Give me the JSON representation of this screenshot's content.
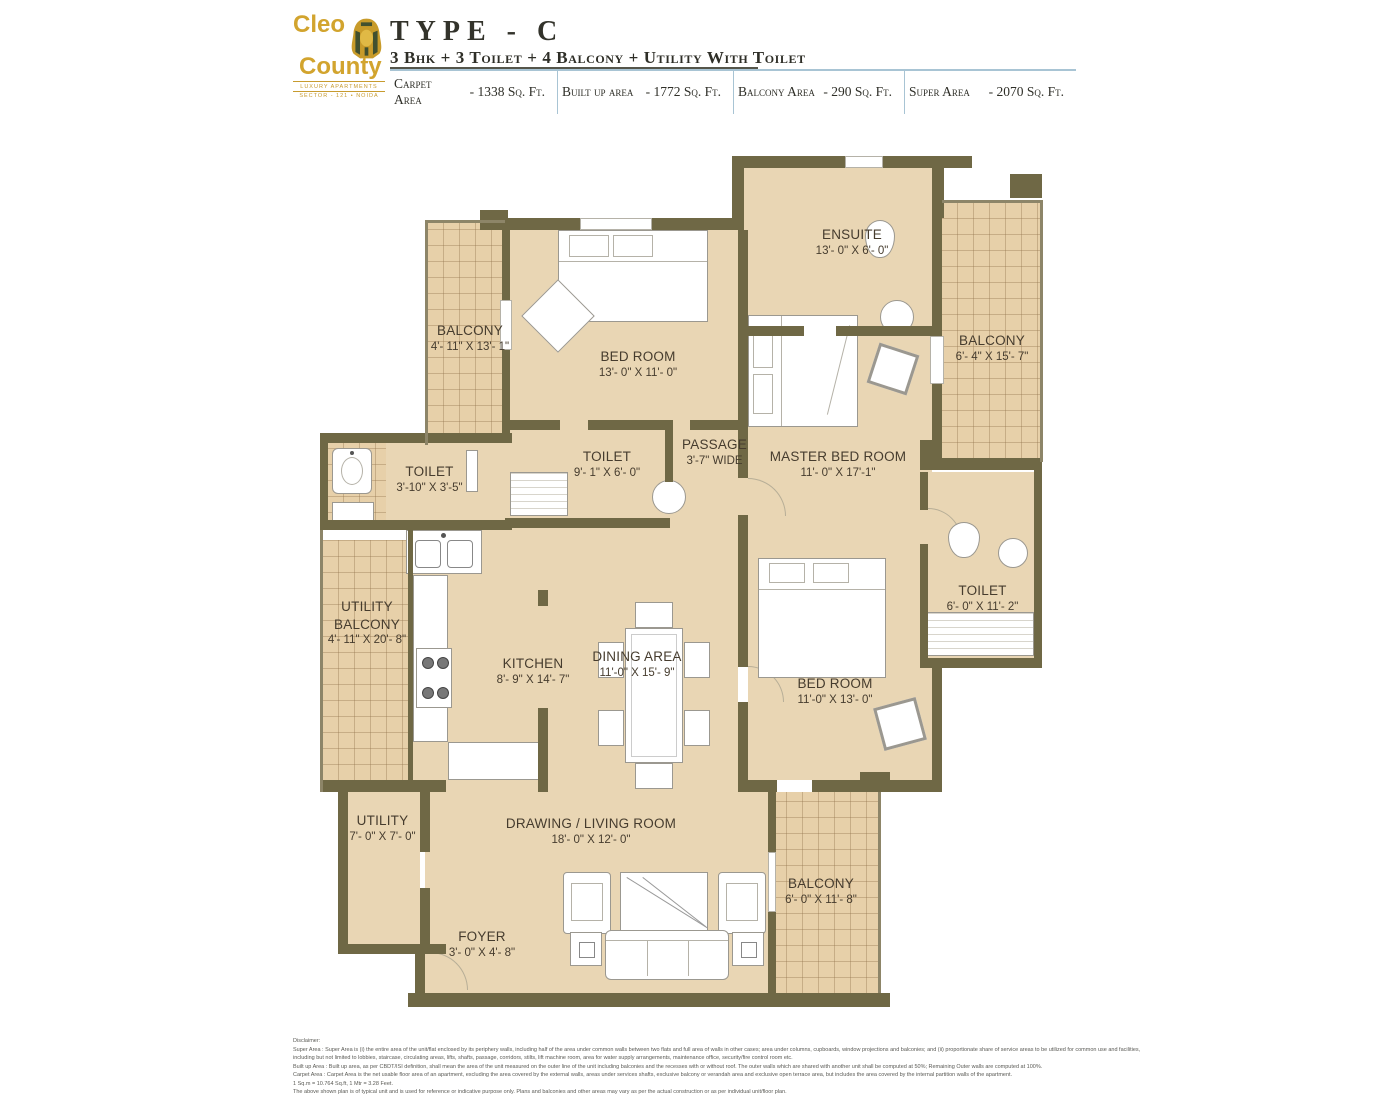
{
  "header": {
    "logo": {
      "line1": "Cleo",
      "line2": "County",
      "sub1": "LUXURY APARTMENTS",
      "sub2": "SECTOR - 121 • NOIDA"
    },
    "title": "TYPE - C",
    "subtitle": "3 Bhk + 3 Toilet + 4 Balcony + Utility With Toilet",
    "areas": [
      {
        "label": "Carpet Area",
        "value": "- 1338 Sq. Ft."
      },
      {
        "label": "Built up area",
        "value": "- 1772 Sq. Ft."
      },
      {
        "label": "Balcony Area",
        "value": "- 290 Sq. Ft."
      },
      {
        "label": "Super Area",
        "value": "- 2070 Sq. Ft."
      }
    ]
  },
  "rooms": [
    {
      "name": "BALCONY",
      "dim": "4'- 11\" X 13'- 1\""
    },
    {
      "name": "BED ROOM",
      "dim": "13'- 0\" X 11'- 0\""
    },
    {
      "name": "ENSUITE",
      "dim": "13'- 0\" X 6'- 0\""
    },
    {
      "name": "BALCONY",
      "dim": "6'- 4\" X 15'- 7\""
    },
    {
      "name": "MASTER BED ROOM",
      "dim": "11'- 0\" X 17'-1\""
    },
    {
      "name": "PASSAGE",
      "dim": "3'-7\" WIDE"
    },
    {
      "name": "TOILET",
      "dim": "9'- 1\" X 6'- 0\""
    },
    {
      "name": "TOILET",
      "dim": "3'-10\" X 3'-5\""
    },
    {
      "name": "TOILET",
      "dim": "6'- 0\" X 11'- 2\""
    },
    {
      "name": "UTILITY BALCONY",
      "dim": "4'- 11\" X 20'- 8\""
    },
    {
      "name": "KITCHEN",
      "dim": "8'- 9\" X 14'- 7\""
    },
    {
      "name": "DINING AREA",
      "dim": "11'-0\" X 15'- 9\""
    },
    {
      "name": "BED ROOM",
      "dim": "11'-0\" X 13'- 0\""
    },
    {
      "name": "UTILITY",
      "dim": "7'- 0\" X 7'- 0\""
    },
    {
      "name": "DRAWING / LIVING ROOM",
      "dim": "18'- 0\" X 12'- 0\""
    },
    {
      "name": "BALCONY",
      "dim": "6'- 0\" X 11'- 8\""
    },
    {
      "name": "FOYER",
      "dim": "3'- 0\" X 4'- 8\""
    }
  ],
  "disclaimer": {
    "lines": [
      "Disclaimer:",
      "Super Area : Super Area is (i) the entire area of the unit/flat enclosed by its periphery walls, including half of the area under common walls between two flats and full area of walls in other cases; area under columns, cupboards, window projections and balconies; and (ii) proportionate share of service areas to be utilized for common use and facilities,",
      "including but not limited to lobbies, staircase, circulating areas, lifts, shafts, passage, corridors, stilts, lift machine room, area for water supply arrangements, maintenance office, security/fire control room etc.",
      "Built up Area : Built up area, as per CBDT/ISI definition, shall mean the area of the unit measured on the outer line of the unit including balconies and the recesses with or without roof. The outer walls which are shared with another unit shall be computed at 50%; Remaining Outer walls are computed at 100%.",
      "Carpet Area : Carpet Area is the net usable floor area of an apartment, excluding the area covered by the external walls, areas under services shafts, exclusive balcony or verandah area and exclusive open terrace area, but includes the area covered by the internal partition walls of the apartment.",
      "1 Sq.m = 10.764 Sq.ft, 1 Mtr = 3.28 Feet.",
      "The above shown plan is of typical unit and is used for reference or indicative purpose only. Plans and balconies and other areas may vary as per the actual construction or as per individual unit/floor plan."
    ]
  },
  "colors": {
    "wall": "#6f6845",
    "floor": "#e9d6b4",
    "gold": "#d2a42e",
    "divider": "#a8c4d4"
  }
}
